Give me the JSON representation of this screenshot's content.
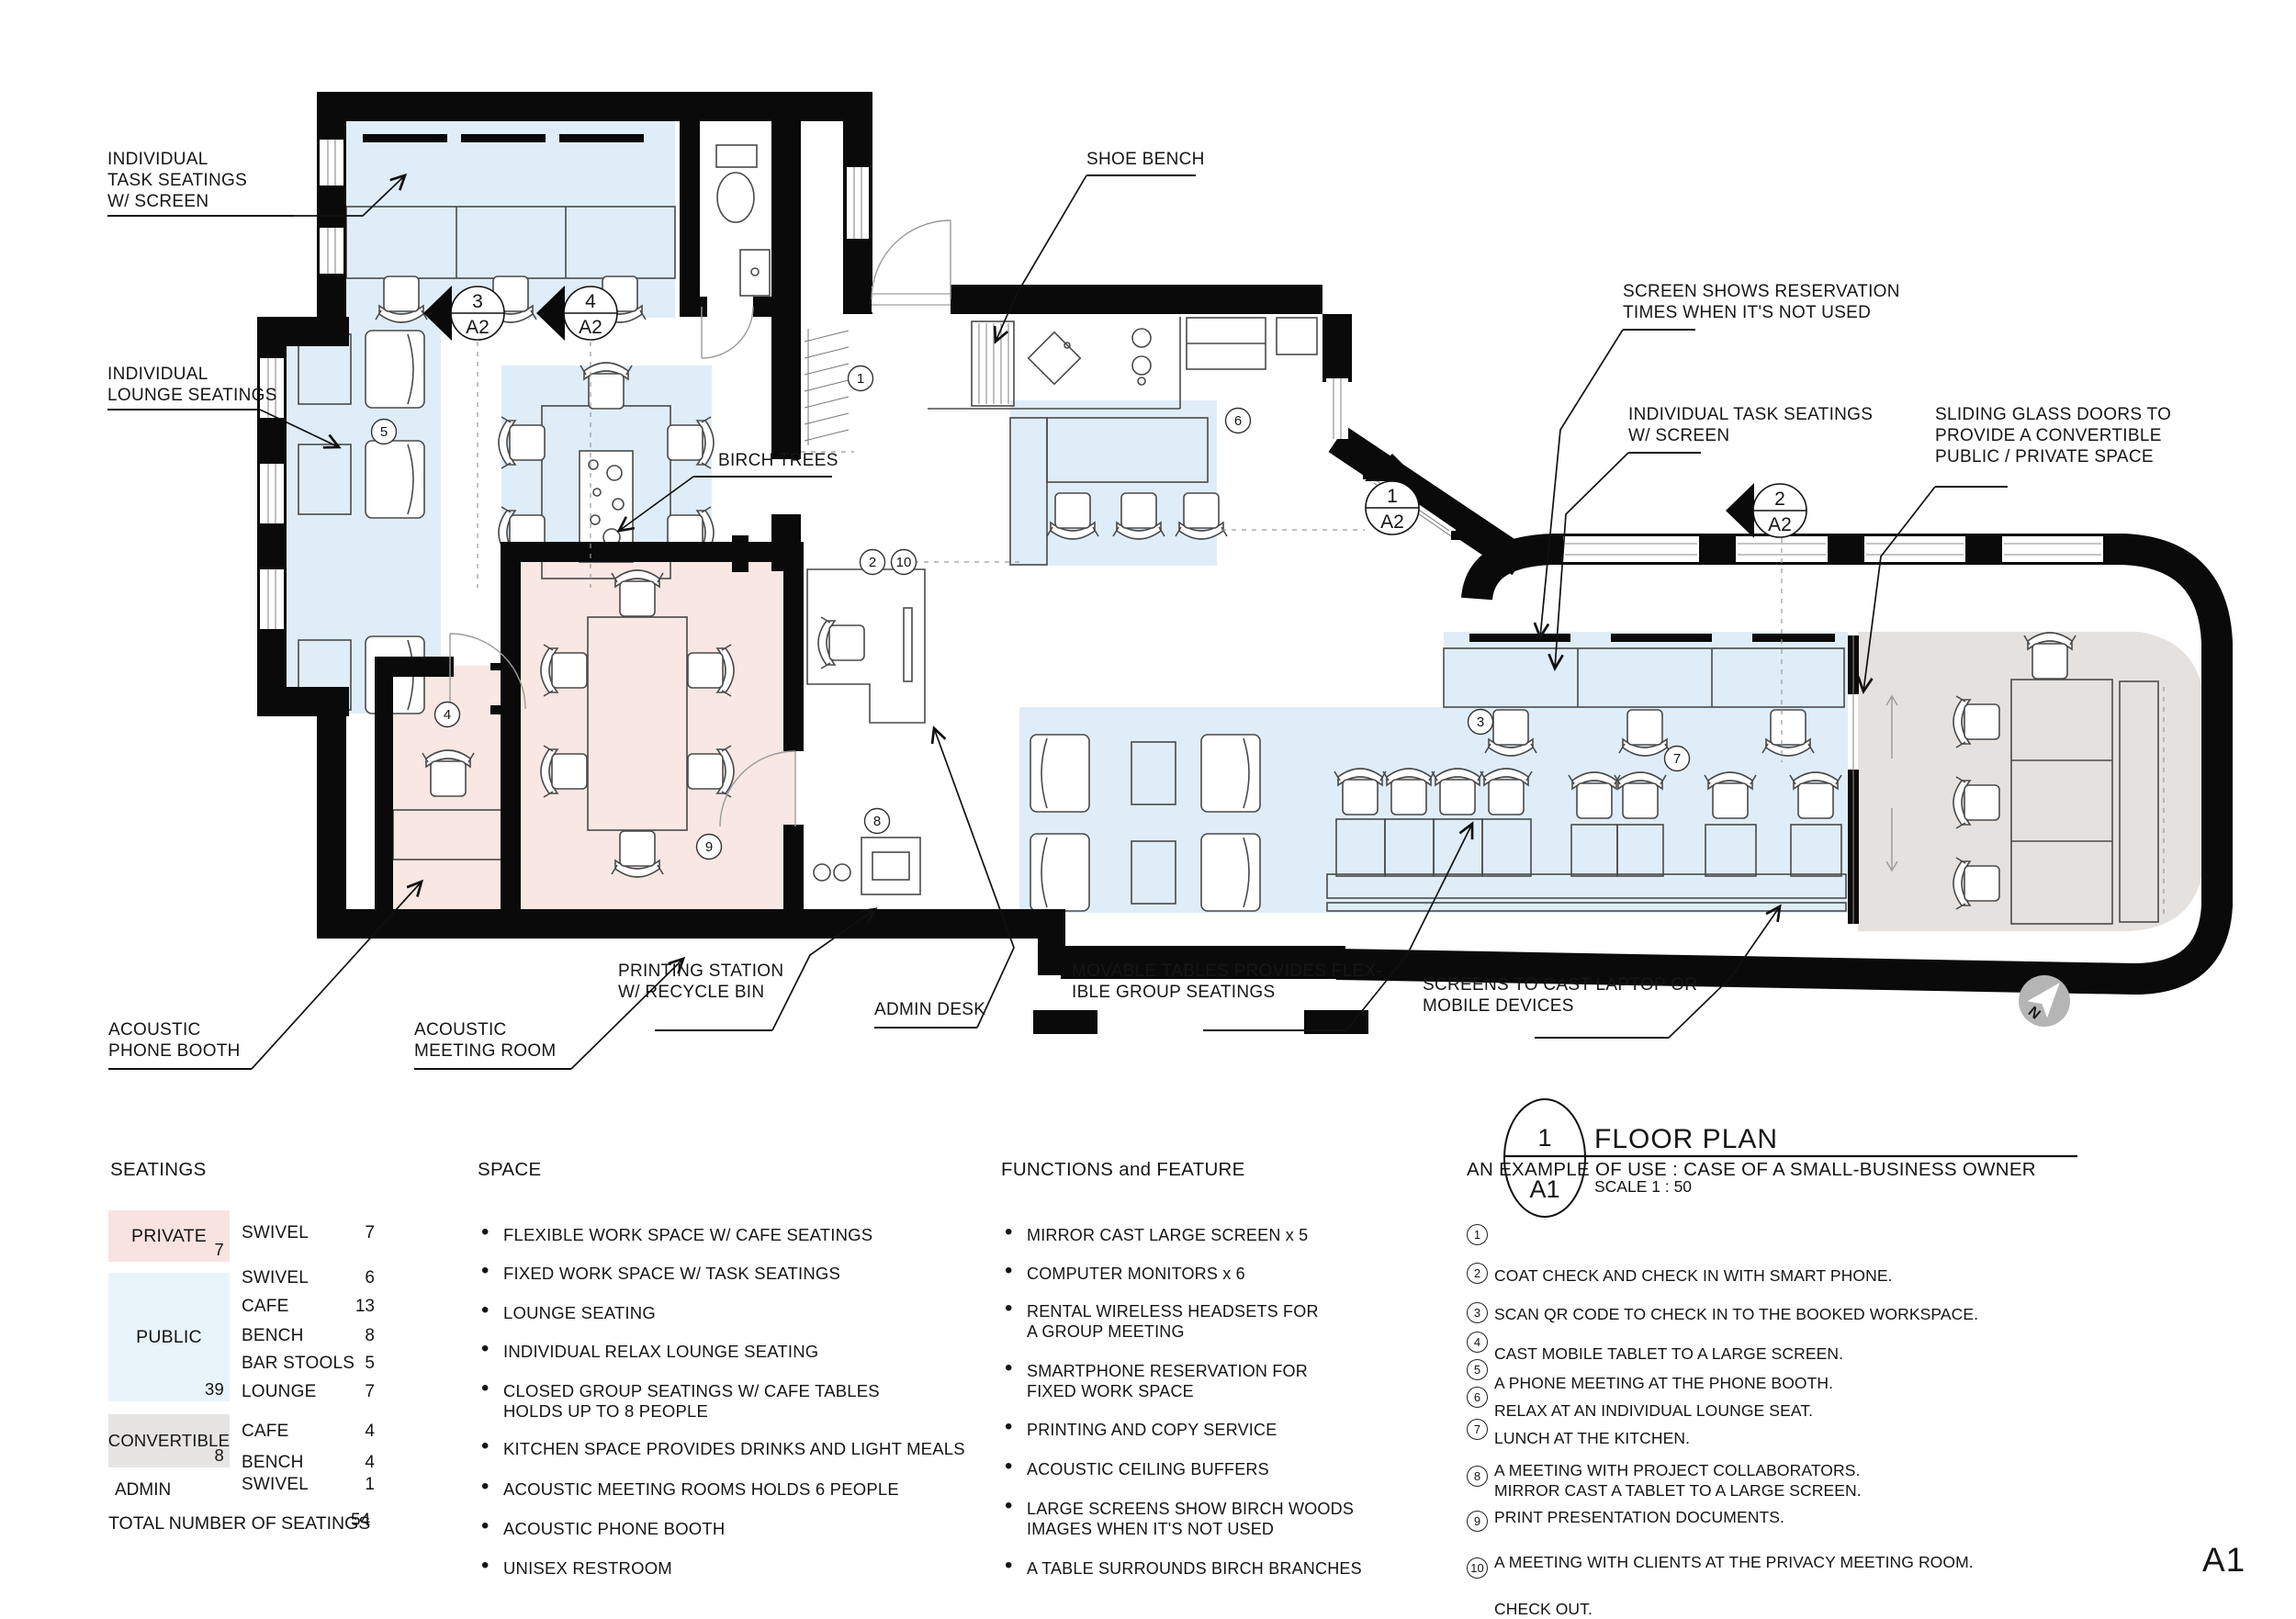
{
  "plan": {
    "annotations": {
      "task_left": "INDIVIDUAL\nTASK SEATINGS\nW/ SCREEN",
      "lounge": "INDIVIDUAL\nLOUNGE SEATINGS",
      "shoe": "SHOE BENCH",
      "screen_res": "SCREEN SHOWS RESERVATION\nTIMES WHEN IT'S NOT USED",
      "task_right": "INDIVIDUAL TASK SEATINGS\nW/ SCREEN",
      "sliding": "SLIDING GLASS DOORS TO\nPROVIDE A CONVERTIBLE\nPUBLIC / PRIVATE SPACE",
      "birch": "BIRCH TREES",
      "phone": "ACOUSTIC\nPHONE BOOTH",
      "meeting": "ACOUSTIC\nMEETING ROOM",
      "printing": "PRINTING STATION\nW/ RECYCLE BIN",
      "admin": "ADMIN DESK",
      "movable": "MOVABLE TABLES PROVIDES FLEX-\nIBLE GROUP SEATINGS",
      "screens_cast": "SCREENS TO CAST LAPTOP OR\nMOBILE DEVICES"
    },
    "markers": [
      {
        "num": "3",
        "sheet": "A2"
      },
      {
        "num": "4",
        "sheet": "A2"
      },
      {
        "num": "1",
        "sheet": "A2"
      },
      {
        "num": "2",
        "sheet": "A2"
      }
    ],
    "circled": {
      "c1": "1",
      "c2": "2",
      "c3": "3",
      "c4": "4",
      "c5": "5",
      "c6": "6",
      "c7": "7",
      "c8": "8",
      "c9": "9",
      "c10": "10"
    },
    "title_block": {
      "num": "1",
      "sheet": "A1",
      "name": "FLOOR PLAN",
      "scale": "SCALE 1 : 50"
    },
    "north_label": "N",
    "page_label": "A1"
  },
  "colors": {
    "wall": "#0a0a0a",
    "public_zone": "#dfedf8",
    "private_zone": "#f8e7e2",
    "convertible_zone": "#e5e1de",
    "legend_private": "#f9e3e0",
    "legend_public": "#e9f3fa",
    "legend_convertible": "#e6e5e4",
    "north_icon": "#b5b5b5"
  },
  "legend": {
    "seatings": {
      "title": "SEATINGS",
      "groups": [
        {
          "name": "PRIVATE",
          "total": "7",
          "rows": [
            {
              "type": "SWIVEL",
              "count": "7"
            }
          ]
        },
        {
          "name": "PUBLIC",
          "total": "39",
          "rows": [
            {
              "type": "SWIVEL",
              "count": "6"
            },
            {
              "type": "CAFE",
              "count": "13"
            },
            {
              "type": "BENCH",
              "count": "8"
            },
            {
              "type": "BAR STOOLS",
              "count": "5"
            },
            {
              "type": "LOUNGE",
              "count": "7"
            }
          ]
        },
        {
          "name": "CONVERTIBLE",
          "total": "8",
          "rows": [
            {
              "type": "CAFE",
              "count": "4"
            },
            {
              "type": "BENCH",
              "count": "4"
            }
          ]
        },
        {
          "name": "ADMIN",
          "rows": [
            {
              "type": "SWIVEL",
              "count": "1"
            }
          ]
        }
      ],
      "total_label": "TOTAL NUMBER OF SEATINGS",
      "total_count": "54"
    },
    "space": {
      "title": "SPACE",
      "items": [
        "FLEXIBLE WORK SPACE W/ CAFE SEATINGS",
        "FIXED WORK SPACE W/ TASK SEATINGS",
        "LOUNGE SEATING",
        "INDIVIDUAL RELAX LOUNGE SEATING",
        "CLOSED GROUP SEATINGS W/ CAFE TABLES\nHOLDS UP TO 8 PEOPLE",
        "KITCHEN SPACE PROVIDES DRINKS AND LIGHT MEALS",
        "ACOUSTIC MEETING ROOMS HOLDS 6 PEOPLE",
        "ACOUSTIC PHONE BOOTH",
        "UNISEX RESTROOM"
      ]
    },
    "functions": {
      "title": "FUNCTIONS and FEATURE",
      "items": [
        "MIRROR CAST LARGE SCREEN x 5",
        "COMPUTER MONITORS x 6",
        "RENTAL WIRELESS HEADSETS FOR\nA GROUP MEETING",
        "SMARTPHONE RESERVATION FOR\nFIXED WORK SPACE",
        "PRINTING AND COPY SERVICE",
        "ACOUSTIC CEILING BUFFERS",
        "LARGE SCREENS SHOW BIRCH WOODS\nIMAGES WHEN IT'S NOT USED",
        "A TABLE SURROUNDS BIRCH BRANCHES"
      ]
    },
    "example": {
      "title": "AN EXAMPLE OF USE : CASE OF A SMALL-BUSINESS OWNER",
      "items": [
        {
          "num": "1",
          "text": "COAT CHECK AND CHECK IN WITH SMART PHONE."
        },
        {
          "num": "2",
          "text": "SCAN QR CODE TO CHECK IN TO THE BOOKED WORKSPACE."
        },
        {
          "num": "3",
          "text": "CAST MOBILE TABLET TO A LARGE SCREEN."
        },
        {
          "num": "4",
          "text": "A PHONE MEETING AT THE PHONE BOOTH."
        },
        {
          "num": "5",
          "text": "RELAX AT AN INDIVIDUAL LOUNGE SEAT."
        },
        {
          "num": "6",
          "text": "LUNCH AT THE KITCHEN."
        },
        {
          "num": "7",
          "text": "A MEETING WITH PROJECT COLLABORATORS.\nMIRROR CAST A TABLET TO A LARGE SCREEN."
        },
        {
          "num": "8",
          "text": "PRINT PRESENTATION DOCUMENTS."
        },
        {
          "num": "9",
          "text": "A MEETING WITH CLIENTS AT THE PRIVACY MEETING ROOM."
        },
        {
          "num": "10",
          "text": "CHECK OUT."
        }
      ]
    }
  }
}
